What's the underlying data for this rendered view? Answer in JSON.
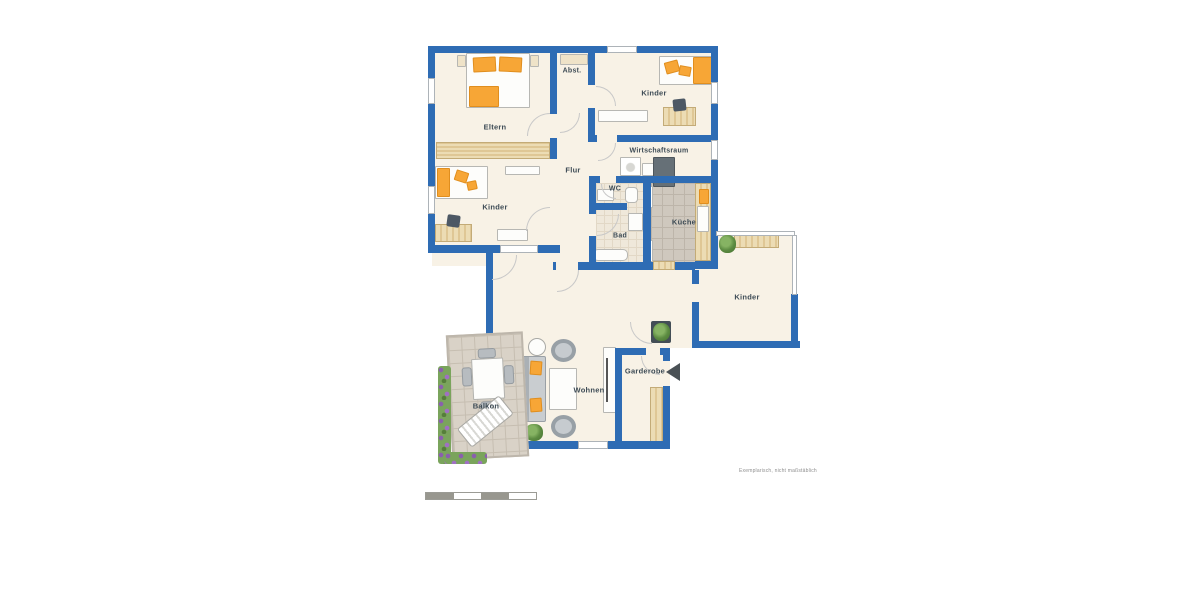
{
  "plan": {
    "rooms": {
      "eltern": {
        "label": "Eltern"
      },
      "abstellraum": {
        "label": "Abst."
      },
      "kinder_top": {
        "label": "Kinder"
      },
      "wirtschaftsraum": {
        "label": "Wirtschaftsraum"
      },
      "flur": {
        "label": "Flur"
      },
      "wc": {
        "label": "WC"
      },
      "bad": {
        "label": "Bad"
      },
      "kueche": {
        "label": "Küche"
      },
      "kinder_left": {
        "label": "Kinder"
      },
      "kinder_right": {
        "label": "Kinder"
      },
      "wohnen": {
        "label": "Wohnen"
      },
      "garderobe": {
        "label": "Garderobe"
      },
      "balkon": {
        "label": "Balkon"
      }
    },
    "disclaimer": "Exemplarisch, nicht maßstäblich"
  },
  "colors": {
    "wall": "#2e6cb4",
    "floor": "#f8f2e6",
    "accent_orange": "#f7a636",
    "wood": "#ecd9ae",
    "tile_gray": "#cfc8be",
    "tile_beige": "#efe8da",
    "balcony_tile": "#d9d2c7",
    "label": "#3d4b55",
    "window_frame": "#adb3b8",
    "plant_green": "#4c7a38",
    "arrow": "#4a5156"
  },
  "icons": {
    "entrance_arrow": "left-pointing-triangle",
    "plant": "green foliage blob",
    "flower_bed": "purple-green dotted strip"
  }
}
